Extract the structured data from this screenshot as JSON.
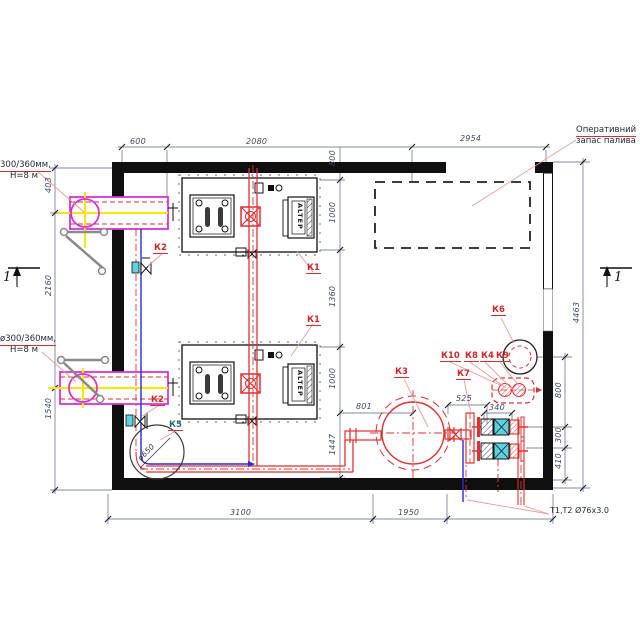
{
  "labels": {
    "fuel_reserve": {
      "line1": "Оперативний",
      "line2": "запас палива"
    },
    "chimney_top": {
      "line1": "300/360мм,",
      "line2": "Н=8 м"
    },
    "chimney_bottom": {
      "line1": "ø300/360мм,",
      "line2": "Н=8 м"
    },
    "pipe_note": "Т1,Т2 Ø76х3.0",
    "burner": "ALTEP",
    "k5_diameter": "ø650"
  },
  "equipment": {
    "k1": "К1",
    "k2": "К2",
    "k3": "К3",
    "k4": "К4",
    "k5": "К5",
    "k6": "К6",
    "k7": "К7",
    "k8": "К8",
    "k9": "К9",
    "k10": "К10"
  },
  "dims": {
    "top": {
      "d1": "600",
      "d2": "2080",
      "d3": "2954"
    },
    "left": {
      "d1": "403",
      "d2": "2160",
      "d3": "1540"
    },
    "right_outer": "4463",
    "right_inner": {
      "d1": "800",
      "d2": "300",
      "d3": "410"
    },
    "mid": {
      "d1": "800",
      "d2": "1000",
      "d3": "1360",
      "d4": "1000",
      "d5": "1447"
    },
    "horizontal": {
      "d1": "801",
      "d2": "525",
      "d3": "340"
    },
    "bottom": {
      "d1": "3100",
      "d2": "1950"
    }
  },
  "section": {
    "left": "1",
    "right": "1"
  },
  "colors": {
    "wall": "#0f0f0f",
    "pipe_red": "#e03030",
    "pipe_blue": "#2b2bd5",
    "duct_magenta": "#d633d6",
    "centerline_yellow": "#ffe600",
    "pump_cyan": "#5ecfdf",
    "label_red": "#cc2a2a",
    "leader_pink": "#f0a0a0"
  }
}
